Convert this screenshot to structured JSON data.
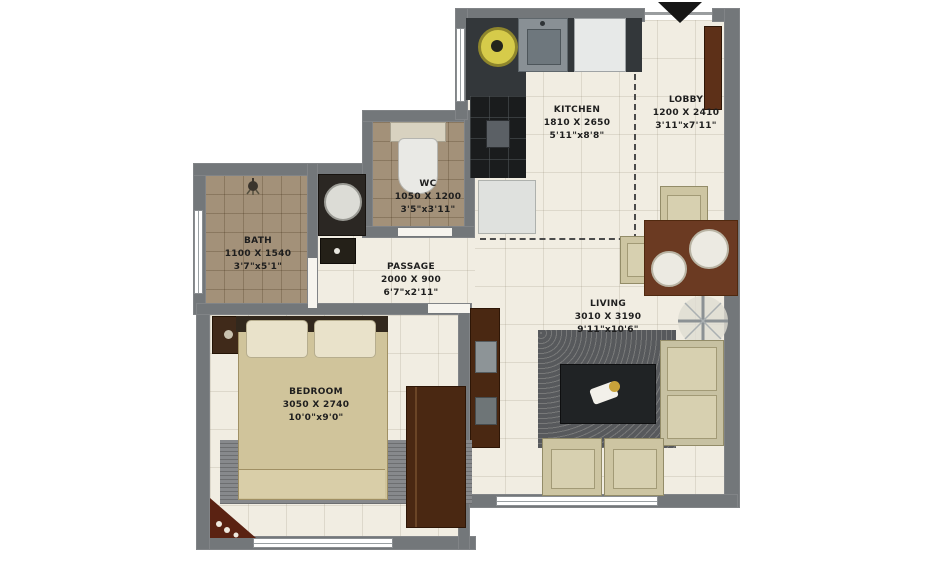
{
  "rooms": [
    {
      "name": "KITCHEN",
      "size_mm": "1810 X 2650",
      "size_ft": "5'11\"x8'8\""
    },
    {
      "name": "LOBBY",
      "size_mm": "1200 X 2410",
      "size_ft": "3'11\"x7'11\""
    },
    {
      "name": "WC",
      "size_mm": "1050 X 1200",
      "size_ft": "3'5\"x3'11\""
    },
    {
      "name": "BATH",
      "size_mm": "1100 X 1540",
      "size_ft": "3'7\"x5'1\""
    },
    {
      "name": "PASSAGE",
      "size_mm": "2000 X 900",
      "size_ft": "6'7\"x2'11\""
    },
    {
      "name": "LIVING",
      "size_mm": "3010 X 3190",
      "size_ft": "9'11\"x10'6\""
    },
    {
      "name": "BEDROOM",
      "size_mm": "3050 X 2740",
      "size_ft": "10'0\"x9'0\""
    }
  ],
  "icons": {
    "entry": "entry-arrow",
    "fan": "ceiling-fan",
    "shower": "shower",
    "toilet": "toilet",
    "basin": "wash-basin",
    "sink": "kitchen-sink",
    "hob": "gas-hob",
    "tv": "tv-unit"
  },
  "colors": {
    "wall": "#73777a",
    "floor": "#f1ede2",
    "bath_tile": "#a39179",
    "kitchen_counter": "#33373a",
    "stove_tile": "#1a1c1d",
    "wood_dark": "#4a2812",
    "wood_mid": "#6b3a22",
    "upholstery": "#cdc5a2",
    "bed": "#d0c49b",
    "hob_yellow": "#d6cb4a",
    "arrow_black": "#161616"
  }
}
